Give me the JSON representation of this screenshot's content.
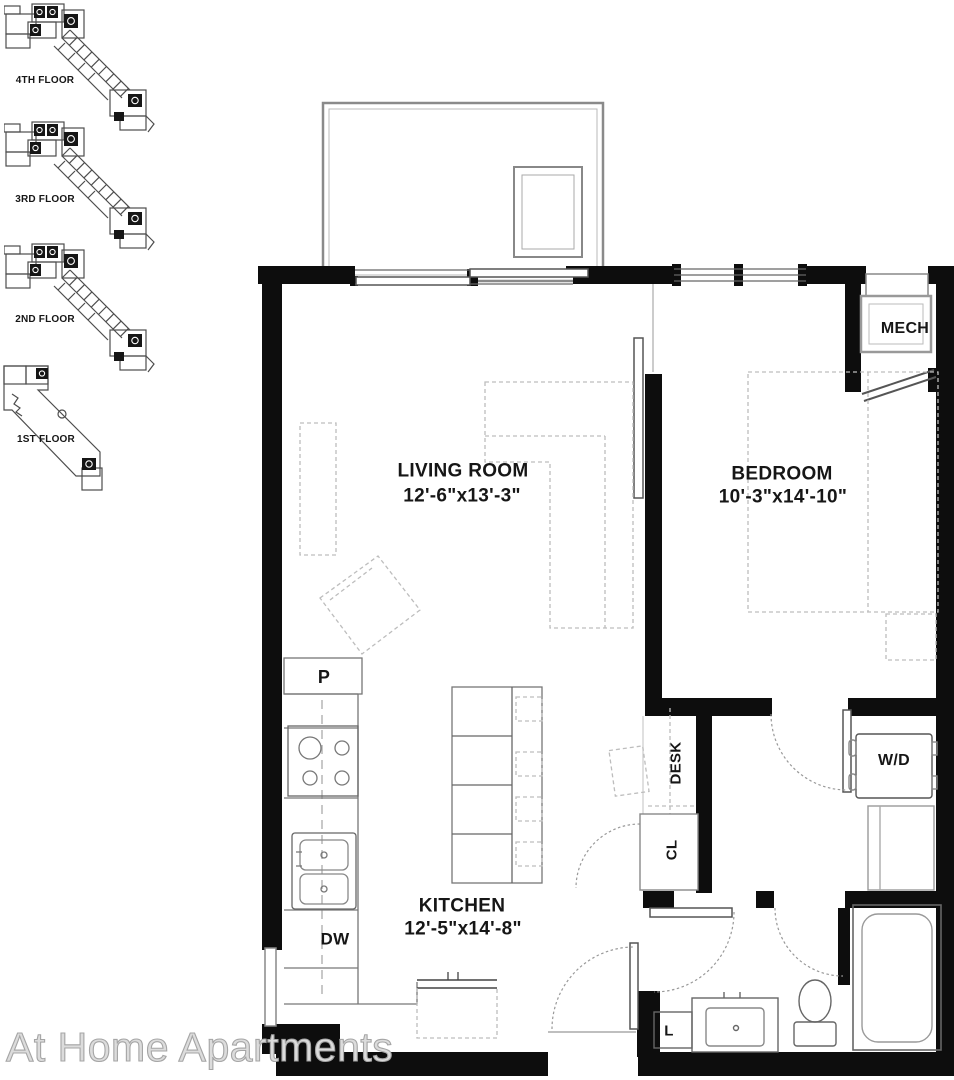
{
  "watermark": "At Home Apartments",
  "floor_key": [
    {
      "label": "4TH FLOOR"
    },
    {
      "label": "3RD FLOOR"
    },
    {
      "label": "2ND FLOOR"
    },
    {
      "label": "1ST FLOOR"
    }
  ],
  "labels": {
    "living_room": {
      "name": "LIVING ROOM",
      "dims": "12'-6\"x13'-3\""
    },
    "bedroom": {
      "name": "BEDROOM",
      "dims": "10'-3\"x14'-10\""
    },
    "kitchen": {
      "name": "KITCHEN",
      "dims": "12'-5\"x14'-8\""
    },
    "mech": "MECH",
    "washer_dryer": "W/D",
    "desk": "DESK",
    "closet": "CL",
    "pantry": "P",
    "dishwasher": "DW",
    "linen": "L"
  },
  "colors": {
    "wall": "#0d0d0d",
    "fixture_line": "#666666",
    "light_line": "#999999",
    "furniture_dash": "#bdbdbd",
    "watermark": "#bdbdbd"
  }
}
